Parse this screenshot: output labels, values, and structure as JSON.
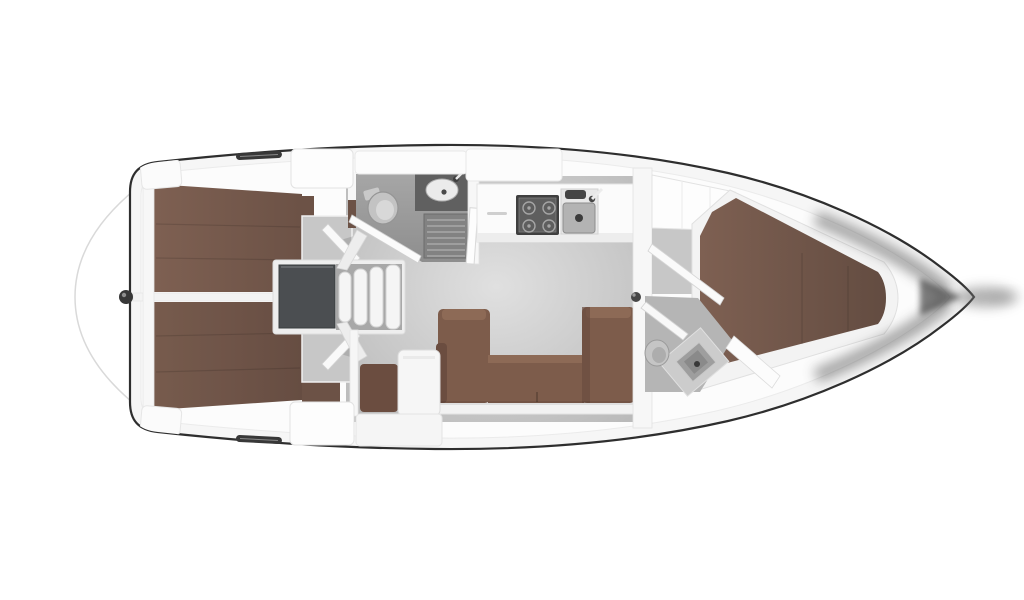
{
  "meta": {
    "subject": "Sailing yacht interior layout plan, top-down view, bow pointing right",
    "diagram_type": "boat-floor-plan",
    "visible_text": "none"
  },
  "colors": {
    "background": "#ffffff",
    "hull_outline": "#2e2e2e",
    "hull_fill": "#f6f6f6",
    "deck": "#fcfcfc",
    "wall": "#f7f7f7",
    "salon_floor_light": "#e0e0e0",
    "salon_floor_dark": "#b9b9b9",
    "cabin_floor": "#c7c7c7",
    "head_floor_light": "#a6a6a6",
    "head_floor_dark": "#8e8e8e",
    "head_floor_fwd": "#b5b5b5",
    "berth": "#7e6052",
    "berth_dark": "#6c5246",
    "berth_bow": "#634c41",
    "settee": "#7d5c4b",
    "settee_light": "#8d6a56",
    "settee_dark": "#6b4d40",
    "engine_box": "#4b4e51",
    "hatch": "#383838",
    "grate_base": "#828282",
    "grate_slat": "#9e9e9e",
    "stove_frame": "#3f3f3f",
    "stove_face": "#5e5e5e",
    "burner": "#a5a5a5",
    "sink_basin": "#b3b3b3",
    "counter_dark": "#606060",
    "fitting": "#474747",
    "shadow": "#4a4a4a"
  },
  "areas": [
    {
      "id": "swim-platform",
      "label": "Stern swim platform outline"
    },
    {
      "id": "aft-cabin-port",
      "label": "Aft double cabin, port side"
    },
    {
      "id": "aft-cabin-starboard",
      "label": "Aft double cabin, starboard side"
    },
    {
      "id": "engine-compartment",
      "label": "Engine box under companionway"
    },
    {
      "id": "companionway",
      "label": "Companionway steps to cockpit"
    },
    {
      "id": "aft-head",
      "label": "Aft head (WC) with shower grate"
    },
    {
      "id": "galley",
      "label": "Galley with stove and double sink"
    },
    {
      "id": "salon",
      "label": "Salon with U-shaped settee"
    },
    {
      "id": "nav-station",
      "label": "Chart table with navigator seat"
    },
    {
      "id": "forward-head",
      "label": "Forward head (WC) with basin"
    },
    {
      "id": "forward-cabin",
      "label": "Forward cabin with V-berth"
    },
    {
      "id": "bow",
      "label": "Bow"
    }
  ],
  "fixtures": [
    {
      "id": "double-berth-port",
      "label": "Double berth"
    },
    {
      "id": "double-berth-starboard",
      "label": "Double berth"
    },
    {
      "id": "v-berth",
      "label": "V-berth mattress"
    },
    {
      "id": "u-settee",
      "label": "U-shaped salon settee"
    },
    {
      "id": "chart-table",
      "label": "Chart table"
    },
    {
      "id": "nav-seat",
      "label": "Navigator seat"
    },
    {
      "id": "companionway-steps",
      "label": "Four companionway steps"
    },
    {
      "id": "toilet-aft",
      "label": "Marine toilet"
    },
    {
      "id": "toilet-forward",
      "label": "Marine toilet"
    },
    {
      "id": "washbasin-aft",
      "label": "Oval washbasin"
    },
    {
      "id": "washbasin-forward",
      "label": "Square washbasin"
    },
    {
      "id": "shower-grate",
      "label": "Shower floor grate"
    },
    {
      "id": "stove",
      "label": "Four-burner stove"
    },
    {
      "id": "galley-sink",
      "label": "Double galley sink with faucet"
    },
    {
      "id": "wardrobe",
      "label": "Wardrobe lockers"
    },
    {
      "id": "deck-hatch-top",
      "label": "Deck hatch"
    },
    {
      "id": "deck-hatch-bottom",
      "label": "Deck hatch"
    },
    {
      "id": "stern-fitting",
      "label": "Stern deck fitting"
    },
    {
      "id": "grab-post",
      "label": "Bulkhead grab knob"
    }
  ]
}
